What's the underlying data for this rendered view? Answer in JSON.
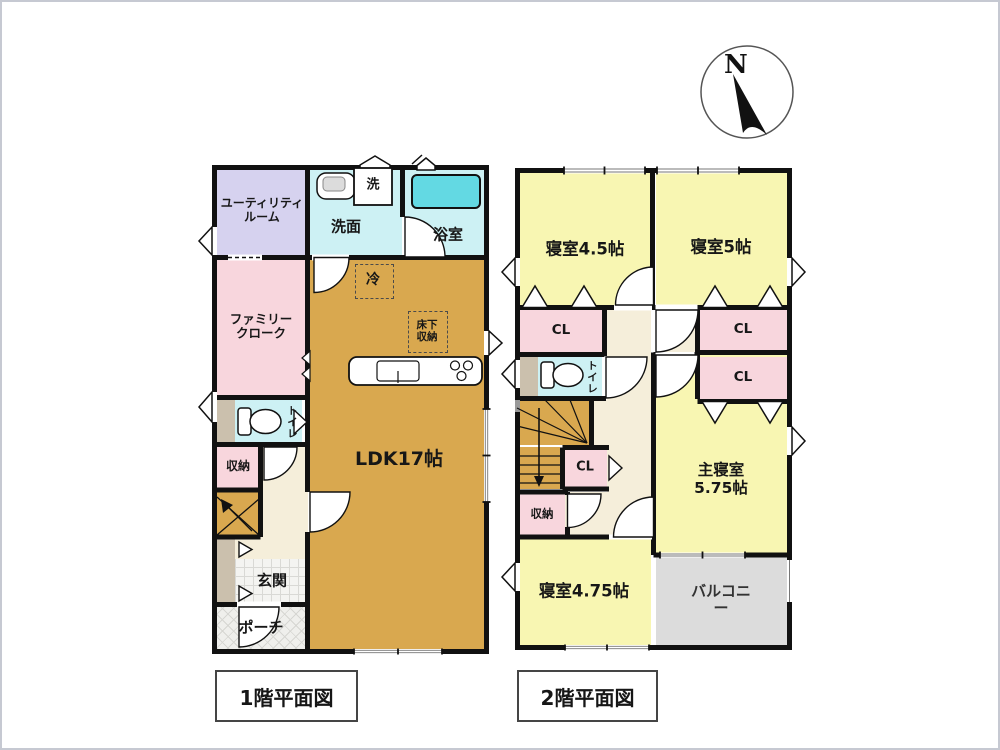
{
  "compass": {
    "label": "N"
  },
  "floor1": {
    "title": "1階平面図",
    "rooms": {
      "utility_room": "ユーティリティ\nルーム",
      "washroom": "洗面",
      "washer": "洗",
      "bathroom": "浴室",
      "fridge": "冷",
      "family_closet": "ファミリー\nクローク",
      "underfloor_storage": "床下\n収納",
      "ldk": "LDK17帖",
      "toilet": "トイレ",
      "storage": "収納",
      "entrance": "玄関",
      "porch": "ポーチ"
    }
  },
  "floor2": {
    "title": "2階平面図",
    "rooms": {
      "bedroom_45": "寝室4.5帖",
      "bedroom_5": "寝室5帖",
      "closet_left": "CL",
      "closet_right_1": "CL",
      "closet_right_2": "CL",
      "toilet": "トイレ",
      "closet_small": "CL",
      "storage": "収納",
      "master_bedroom": "主寝室5.75帖",
      "bedroom_475": "寝室4.75帖",
      "balcony": "バルコニー"
    }
  },
  "colors": {
    "wall": "#111111",
    "ldk_floor": "#d9a84f",
    "bedroom_floor": "#f8f6b2",
    "closet_pink": "#f8d6dd",
    "utility_lavender": "#d6d2ef",
    "wet_area_cyan": "#cdf1f4",
    "bathtub_cyan": "#63d9e3",
    "hall_cream": "#f5eeda",
    "balcony_gray": "#dcdcdc",
    "cabinet_tan": "#cbc0ad"
  }
}
